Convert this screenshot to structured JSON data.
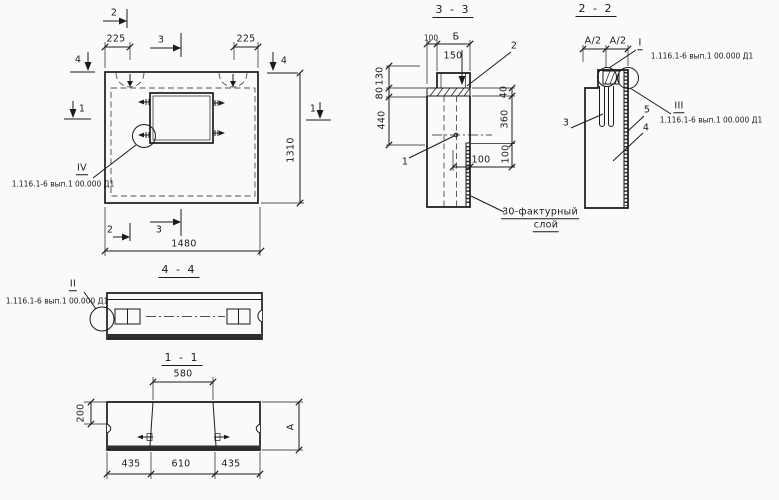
{
  "colors": {
    "ink": "#1b1b1b",
    "paper": "#fafaf8"
  },
  "main_view": {
    "marker_2_top": "2",
    "marker_3_top": "3",
    "marker_4_left": "4",
    "marker_4_right": "4",
    "marker_1_left": "1",
    "marker_1_right": "1",
    "marker_2_bottom": "2",
    "marker_3_bottom": "3",
    "dim_225_left": "225",
    "dim_225_right": "225",
    "dim_width": "1480",
    "dim_height": "1310",
    "detail_label": "IV",
    "detail_ref": "1.116.1-6 вып.1 00.000 Д1"
  },
  "section_3_3": {
    "title": "3 - 3",
    "dim_100_top": "100",
    "dim_b_top": "Б",
    "dim_150": "150",
    "leader_2": "2",
    "leader_1": "1",
    "dim_40": "40",
    "dim_360": "360",
    "dim_100_right": "100",
    "dim_100_bottom": "100",
    "dim_130": "130",
    "dim_80": "80",
    "dim_440": "440",
    "note_line1": "30-фактурный",
    "note_line2": "слой"
  },
  "section_2_2": {
    "title": "2 - 2",
    "dim_a2_left": "А/2",
    "dim_a2_right": "А/2",
    "detail_top_label": "I",
    "detail_top_ref": "1.116.1-6 вып.1 00.000 Д1",
    "detail_side_label": "III",
    "detail_side_ref": "1.116.1-6 вып.1 00.000 Д1",
    "leader_3": "3",
    "leader_5": "5",
    "leader_4": "4"
  },
  "section_4_4": {
    "title": "4 - 4",
    "detail_label": "II",
    "detail_ref": "1.116.1-6 вып.1 00.000 Д1"
  },
  "section_1_1": {
    "title": "1 - 1",
    "dim_580": "580",
    "dim_200": "200",
    "dim_a": "А",
    "dim_435_left": "435",
    "dim_610": "610",
    "dim_435_right": "435"
  }
}
